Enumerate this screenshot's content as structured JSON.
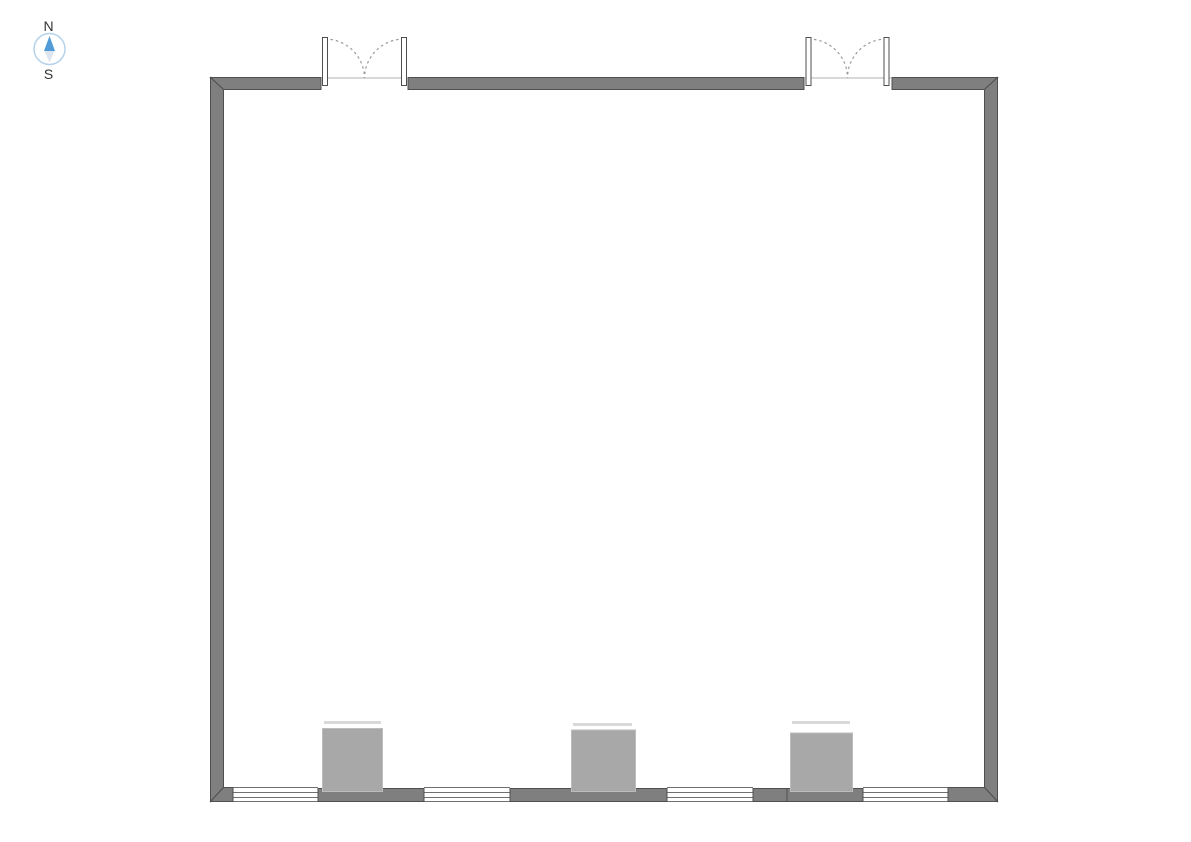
{
  "compass": {
    "north_label": "N",
    "south_label": "S"
  },
  "colors": {
    "wall_fill": "#7f7f7f",
    "wall_outline": "#4f4f4f",
    "window_line": "#707070",
    "pier_fill": "#a8a8a8",
    "pier_edge": "#bcbcbc",
    "pier_shadow": "#d9d9d9",
    "door_leaf_fill": "#ffffff",
    "door_swing": "#9a9a9a",
    "threshold": "#b3b3b3",
    "compass_ring": "#b5d2ea",
    "compass_north": "#4f9ad7",
    "compass_south": "#dde6ee",
    "label_text": "#333333"
  }
}
